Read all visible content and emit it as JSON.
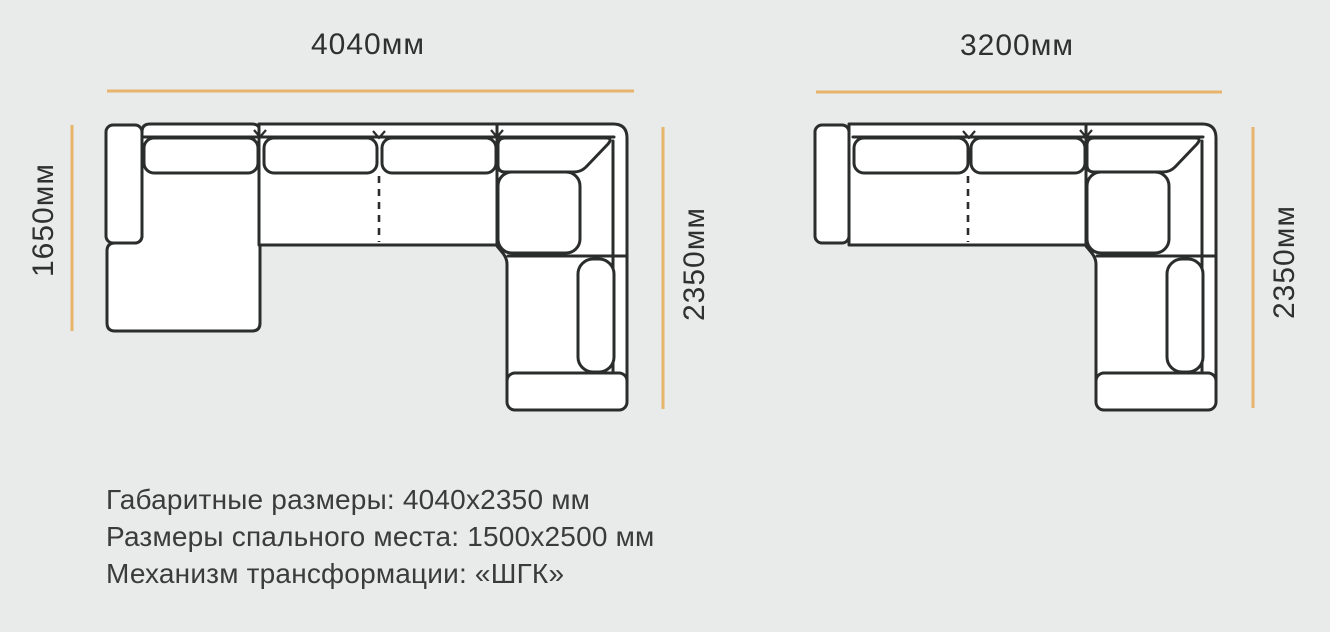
{
  "page": {
    "background_color": "#e9eaea",
    "outline_color": "#2b2c2c",
    "dimension_line_color": "#e8b46c",
    "label_text_color": "#2f3030",
    "specs_text_color": "#3b3b3b",
    "sofa_fill_color": "#ffffff"
  },
  "diagram_left": {
    "description": "corner sofa with chaise, top view",
    "dim_top": "4040мм",
    "dim_left": "1650мм",
    "dim_right": "2350мм"
  },
  "diagram_right": {
    "description": "corner sofa, top view",
    "dim_top": "3200мм",
    "dim_right": "2350мм"
  },
  "specs": {
    "overall": "Габаритные размеры: 4040х2350 мм",
    "sleeping": "Размеры спального места: 1500х2500 мм",
    "mechanism": "Механизм трансформации: «ШГК»"
  }
}
